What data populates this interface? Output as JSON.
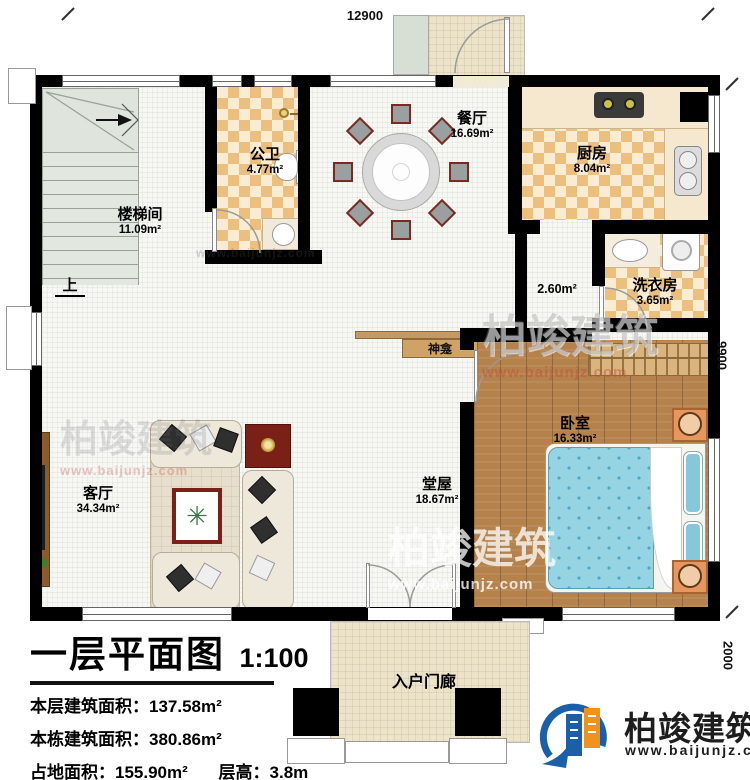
{
  "plan": {
    "title": "一层平面图",
    "scale": "1:100",
    "stats": [
      {
        "label": "本层建筑面积：",
        "value": "137.58m²"
      },
      {
        "label": "本栋建筑面积：",
        "value": "380.86m²"
      },
      {
        "label": "占地面积：",
        "value": "155.90m²"
      },
      {
        "label": "层高：",
        "value": "3.8m"
      }
    ]
  },
  "dimensions": {
    "top": "12900",
    "right": "9900",
    "porch": "2000"
  },
  "rooms": [
    {
      "name": "楼梯间",
      "area": "11.09m²"
    },
    {
      "name": "公卫",
      "area": "4.77m²"
    },
    {
      "name": "餐厅",
      "area": "16.69m²"
    },
    {
      "name": "厨房",
      "area": "8.04m²"
    },
    {
      "name": "洗衣房",
      "area": "3.65m²"
    },
    {
      "name": "卧室",
      "area": "16.33m²"
    },
    {
      "name": "堂屋",
      "area": "18.67m²"
    },
    {
      "name": "客厅",
      "area": "34.34m²"
    },
    {
      "name": "入户门廊",
      "area": ""
    },
    {
      "name": "",
      "area": "2.60m²"
    }
  ],
  "labels": {
    "up": "上",
    "shrine": "神龛"
  },
  "brand": {
    "name": "柏竣建筑",
    "url": "www.baijunjz.com",
    "blue": "#1b5fa8",
    "orange": "#f0921e"
  },
  "watermark": {
    "name": "柏竣建筑",
    "url": "www.baijunjz.com"
  }
}
